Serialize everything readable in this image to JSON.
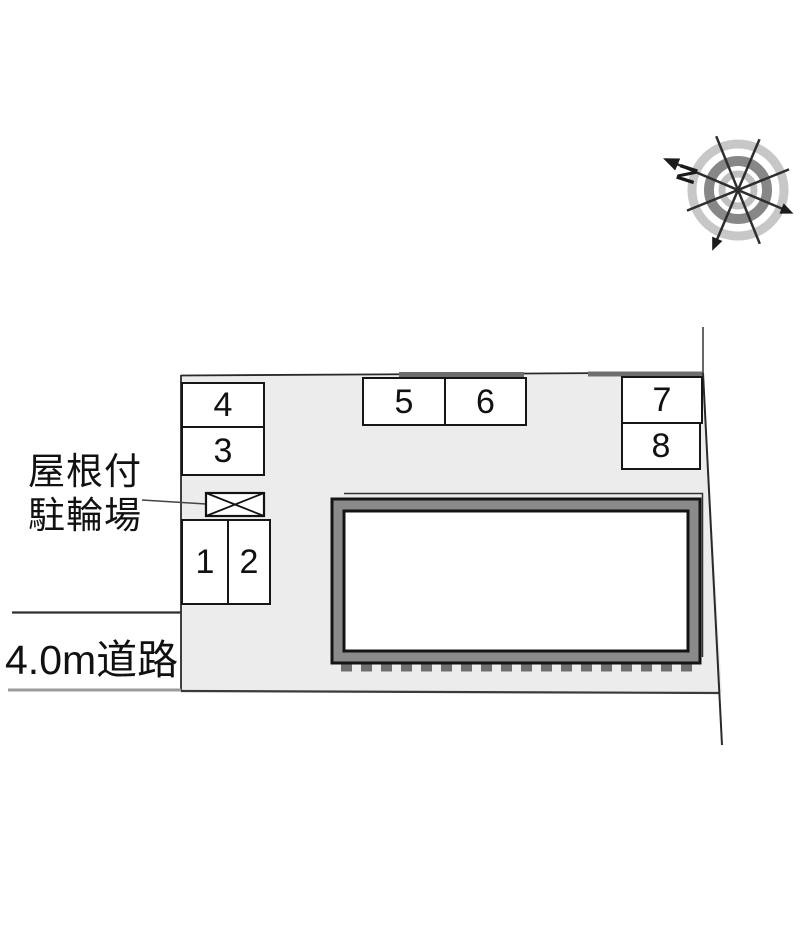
{
  "site_plan": {
    "parking_spaces": [
      {
        "label": "1"
      },
      {
        "label": "2"
      },
      {
        "label": "3"
      },
      {
        "label": "4"
      },
      {
        "label": "5"
      },
      {
        "label": "6"
      },
      {
        "label": "7"
      },
      {
        "label": "8"
      }
    ],
    "annotations": {
      "bicycle_shed_line1": "屋根付",
      "bicycle_shed_line2": "駐輪場",
      "road": "4.0m道路"
    },
    "compass": {
      "north_label": "N"
    },
    "colors": {
      "lot_fill": "#ececec",
      "boundary_line": "#2a2a2a",
      "building_band": "#8a8a8a",
      "wall_segment_gray": "#6e6e6e",
      "dashed_edge_gray": "#6f6f6f",
      "road_lower_edge_gray": "#9b9b9b",
      "compass_outer_ring": "#c7c7c7",
      "compass_mid_ring": "#878787",
      "compass_inner_ring": "#c0c0c0"
    }
  }
}
